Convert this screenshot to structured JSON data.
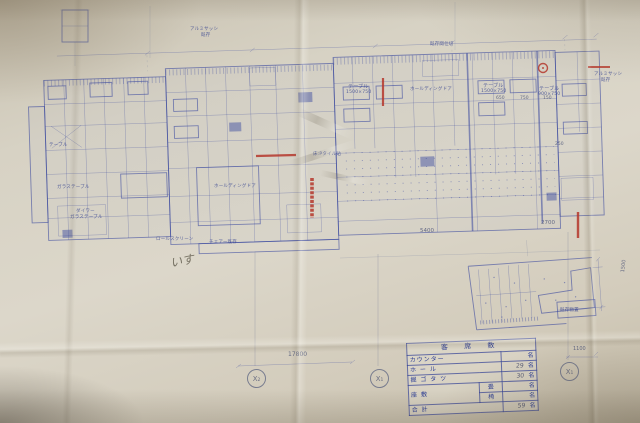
{
  "photo_colors": {
    "paper": "#d7d2c4",
    "ink_blue": "#36459e",
    "mark_red": "#b5372b",
    "pencil": "#5f5a4b"
  },
  "plan": {
    "annotations": [
      {
        "text": "アルミサッシ",
        "x": 190,
        "y": 26,
        "s": 4.5
      },
      {
        "text": "既存",
        "x": 201,
        "y": 32,
        "s": 4.5
      },
      {
        "text": "既存間仕切",
        "x": 430,
        "y": 41,
        "s": 4.5
      },
      {
        "text": "アルミサッシ",
        "x": 594,
        "y": 71,
        "s": 4.5
      },
      {
        "text": "既存",
        "x": 601,
        "y": 77,
        "s": 4.5
      },
      {
        "text": "テーブル",
        "x": 348,
        "y": 83,
        "s": 5
      },
      {
        "text": "1500×750",
        "x": 346,
        "y": 90,
        "s": 4.5
      },
      {
        "text": "テーブル",
        "x": 483,
        "y": 82,
        "s": 5
      },
      {
        "text": "1500×750",
        "x": 481,
        "y": 89,
        "s": 4.5
      },
      {
        "text": "テーブル",
        "x": 539,
        "y": 85,
        "s": 5
      },
      {
        "text": "900×750",
        "x": 538,
        "y": 92,
        "s": 4.5
      },
      {
        "text": "ホールディングドア",
        "x": 410,
        "y": 86,
        "s": 4.5
      },
      {
        "text": "床:Pタイル貼",
        "x": 313,
        "y": 151,
        "s": 4.5
      },
      {
        "text": "ホールディングドア",
        "x": 214,
        "y": 183,
        "s": 4.5
      },
      {
        "text": "ロールスクリーン",
        "x": 156,
        "y": 236,
        "s": 4.5
      },
      {
        "text": "チェアー既存",
        "x": 209,
        "y": 239,
        "s": 4.5
      },
      {
        "text": "ガラステーブル",
        "x": 57,
        "y": 184,
        "s": 4.5
      },
      {
        "text": "ダイワー",
        "x": 76,
        "y": 208,
        "s": 4.5
      },
      {
        "text": "ガラステーブル",
        "x": 70,
        "y": 214,
        "s": 4.5
      },
      {
        "text": "テーブル",
        "x": 49,
        "y": 142,
        "s": 4.5
      },
      {
        "text": "既存物置",
        "x": 560,
        "y": 307,
        "s": 4.5
      }
    ],
    "dimensions": [
      {
        "text": "17800",
        "x": 288,
        "y": 351,
        "s": 6
      },
      {
        "text": "5400",
        "x": 420,
        "y": 228,
        "s": 5.5
      },
      {
        "text": "2700",
        "x": 541,
        "y": 220,
        "s": 5.5
      },
      {
        "text": "1100",
        "x": 573,
        "y": 346,
        "s": 5
      },
      {
        "text": "1500",
        "x": 620,
        "y": 272,
        "s": 5,
        "rot": -83
      },
      {
        "text": "650",
        "x": 496,
        "y": 96,
        "s": 4.5
      },
      {
        "text": "750",
        "x": 520,
        "y": 96,
        "s": 4.5
      },
      {
        "text": "150",
        "x": 543,
        "y": 96,
        "s": 4.5
      },
      {
        "text": "250",
        "x": 555,
        "y": 142,
        "s": 4.5
      }
    ]
  },
  "axis_markers": [
    {
      "label": "X₂",
      "x": 247,
      "y": 369
    },
    {
      "label": "X₁",
      "x": 370,
      "y": 369
    },
    {
      "label": "X₁",
      "x": 560,
      "y": 362
    }
  ],
  "pencil_note": {
    "text": "いす",
    "x": 170,
    "y": 252
  },
  "legend_table": {
    "title": "客 席 数",
    "rows": [
      {
        "label": "カウンター",
        "sub": null,
        "num": "",
        "unit": "名"
      },
      {
        "label": "ホ ー ル",
        "sub": null,
        "num": "29",
        "unit": "名"
      },
      {
        "label": "掘 ゴ タ ツ",
        "sub": null,
        "num": "30",
        "unit": "名"
      },
      {
        "label": "座 敷",
        "sub": "畳",
        "num": "",
        "unit": "名",
        "rowspan": 2
      },
      {
        "label": null,
        "sub": "椅",
        "num": "",
        "unit": "名"
      },
      {
        "label": "合 計",
        "sub": null,
        "num": "59",
        "unit": "名"
      }
    ]
  }
}
